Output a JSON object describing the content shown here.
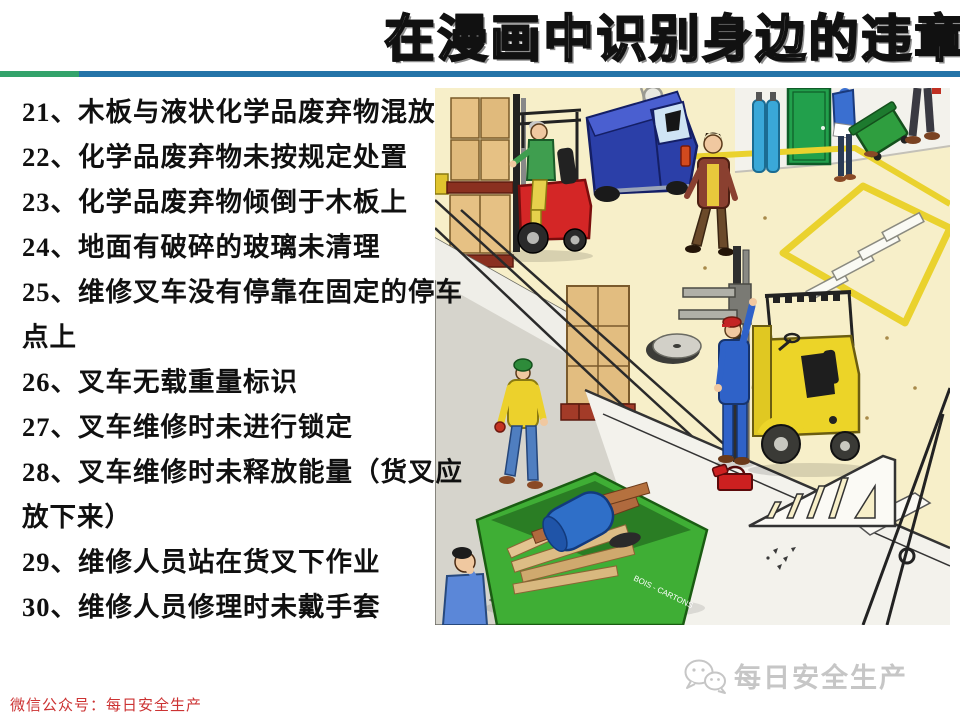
{
  "slide": {
    "title": "在漫画中识别身边的违章"
  },
  "violations": {
    "items": [
      "21、木板与液状化学品废弃物混放",
      "22、化学品废弃物未按规定处置",
      "23、化学品废弃物倾倒于木板上",
      "24、地面有破碎的玻璃未清理",
      "25、维修叉车没有停靠在固定的停车点上",
      "26、叉车无载重量标识",
      "27、叉车维修时未进行锁定",
      "28、叉车维修时未释放能量（货叉应放下来）",
      "29、维修人员站在货叉下作业",
      "30、维修人员修理时未戴手套"
    ]
  },
  "cartoon": {
    "skip_label": "BOIS - CARTONS"
  },
  "footer": {
    "wechat_account": "微信公众号：每日安全生产"
  },
  "watermark": {
    "brand": "每日安全生产"
  },
  "theme": {
    "divider_green": "#33a36b",
    "divider_blue": "#2474a8",
    "footer_red": "#cc3333",
    "watermark_gray": "#c6c6c6",
    "title_outline": "#111111"
  }
}
